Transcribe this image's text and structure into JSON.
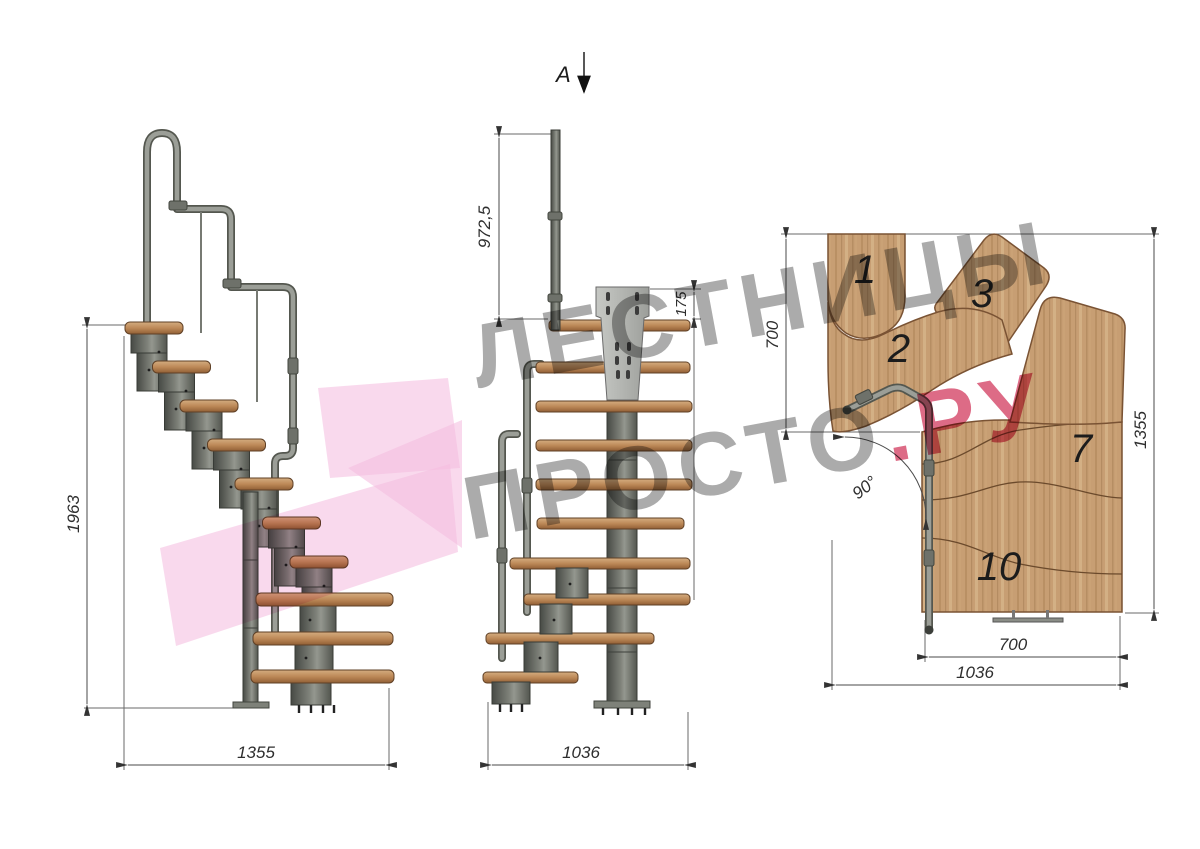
{
  "view_labels": {
    "section_marker": "А"
  },
  "dims": {
    "side_height": "1963",
    "side_depth": "1355",
    "front_post_height": "972,5",
    "front_plate": "175",
    "front_width": "1036",
    "plan_top_offset": "700",
    "plan_length": "1355",
    "plan_flight_width": "700",
    "plan_total_width": "1036",
    "plan_angle": "90°"
  },
  "plan_treads": {
    "n1": "1",
    "n2": "2",
    "n3": "3",
    "n7": "7",
    "n10": "10"
  },
  "watermark": {
    "line1": "ЛЕСТНИЦЫ",
    "line2": "ПРОСТО",
    "line2_suffix": ".РУ"
  },
  "palette": {
    "wood": "#c79e73",
    "metal": "#6a6d66",
    "watermark_gray": "#9c9c9c",
    "watermark_pink": "#f2aed8",
    "watermark_red": "#d75070",
    "dim_line": "#4a4a4a"
  }
}
